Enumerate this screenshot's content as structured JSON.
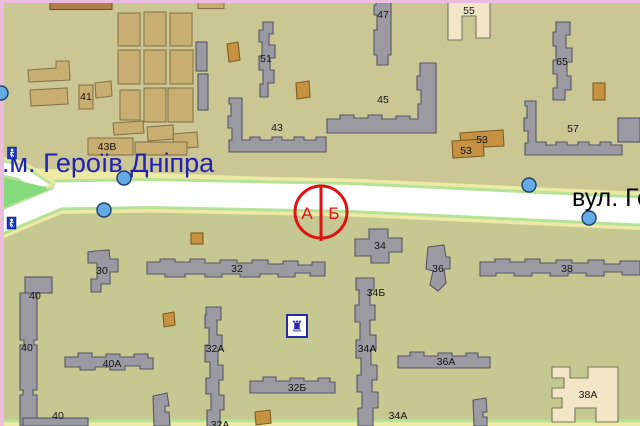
{
  "window": {
    "width": 640,
    "height": 426
  },
  "map": {
    "station_label": ".м. Героїв Дніпра",
    "street_label": "вул. Ге",
    "billboard_marker": {
      "side_left": "А",
      "side_right": "Б"
    },
    "building_labels": [
      "41",
      "43В",
      "47",
      "51",
      "43",
      "45",
      "55",
      "65",
      "53",
      "53",
      "57",
      "34",
      "32",
      "30",
      "36",
      "38",
      "34Б",
      "32А",
      "34А",
      "36А",
      "40",
      "40",
      "40А",
      "32Б",
      "38А",
      "34А",
      "40",
      "32А"
    ],
    "icons": {
      "landmark_glyph": "♜",
      "pedestrian_underpass_icons": 2,
      "metro_entrance_dots": 5
    },
    "colors": {
      "map_background": "#c9c694",
      "map_background_lower": "#c6c892",
      "road_fill": "#ffffff",
      "road_edge_green": "#b5e297",
      "road_edge_yellow": "#eeeaa6",
      "island_green": "#84da7c",
      "building_gray": "#9b9aa2",
      "building_tan": "#c9ae71",
      "building_orange": "#c69140",
      "building_cream": "#f2e6c6",
      "building_brown": "#ae8148",
      "marker_red": "#e01111",
      "station_text_blue": "#2121b3",
      "metro_dot_blue": "#64aae6",
      "pedestrian_icon_blue": "#1738c8",
      "border_pink": "#ecbcdc"
    }
  }
}
